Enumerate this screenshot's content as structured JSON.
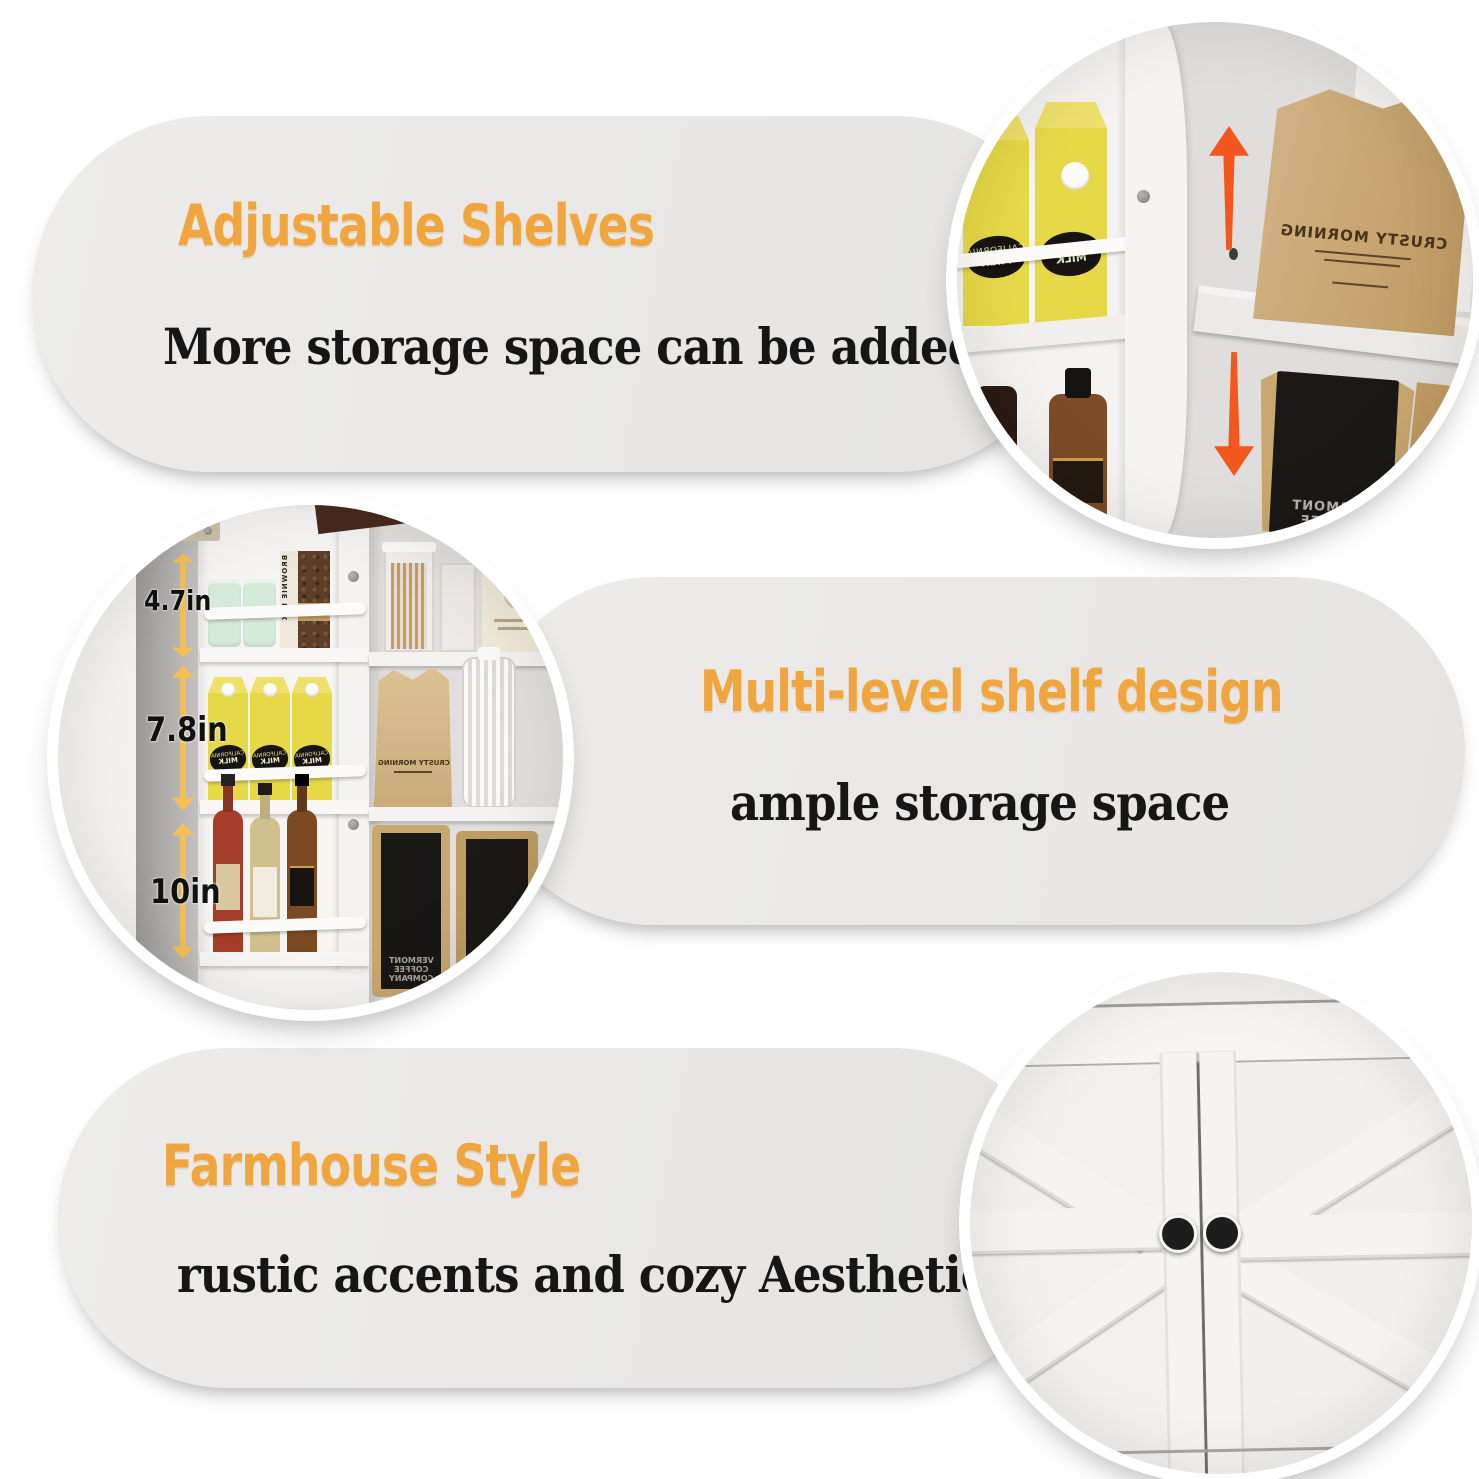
{
  "colors": {
    "accent-orange": "#f1a53e",
    "text-black": "#161616",
    "pill-bg": "#e8e7e5",
    "arrow-red": "#f4571d",
    "measure-arrow-yellow": "#f5bf55",
    "carton-yellow": "#e6d847",
    "kraft-tan": "#c9a86f",
    "page-bg": "#ffffff"
  },
  "sections": [
    {
      "id": "adjustable-shelves",
      "title": "Adjustable Shelves",
      "subtitle": "More storage space can be added"
    },
    {
      "id": "multi-level-shelf",
      "title": "Multi-level shelf design",
      "subtitle": "ample storage space"
    },
    {
      "id": "farmhouse-style",
      "title": "Farmhouse Style",
      "subtitle": "rustic accents and cozy Aesthetic"
    }
  ],
  "measurements": [
    "4.7in",
    "7.8in",
    "10in"
  ],
  "props": {
    "milk_badge_top": "CALIFORNIA",
    "milk_badge_bottom": "MILK",
    "brownie_box": "BROWNIE MIX",
    "bread_bag": "CRUSTY MORNING",
    "flour_bag": "CRUSTY MORNING",
    "coffee_lines": [
      "VERMONT",
      "COFFEE",
      "COMPANY"
    ]
  }
}
